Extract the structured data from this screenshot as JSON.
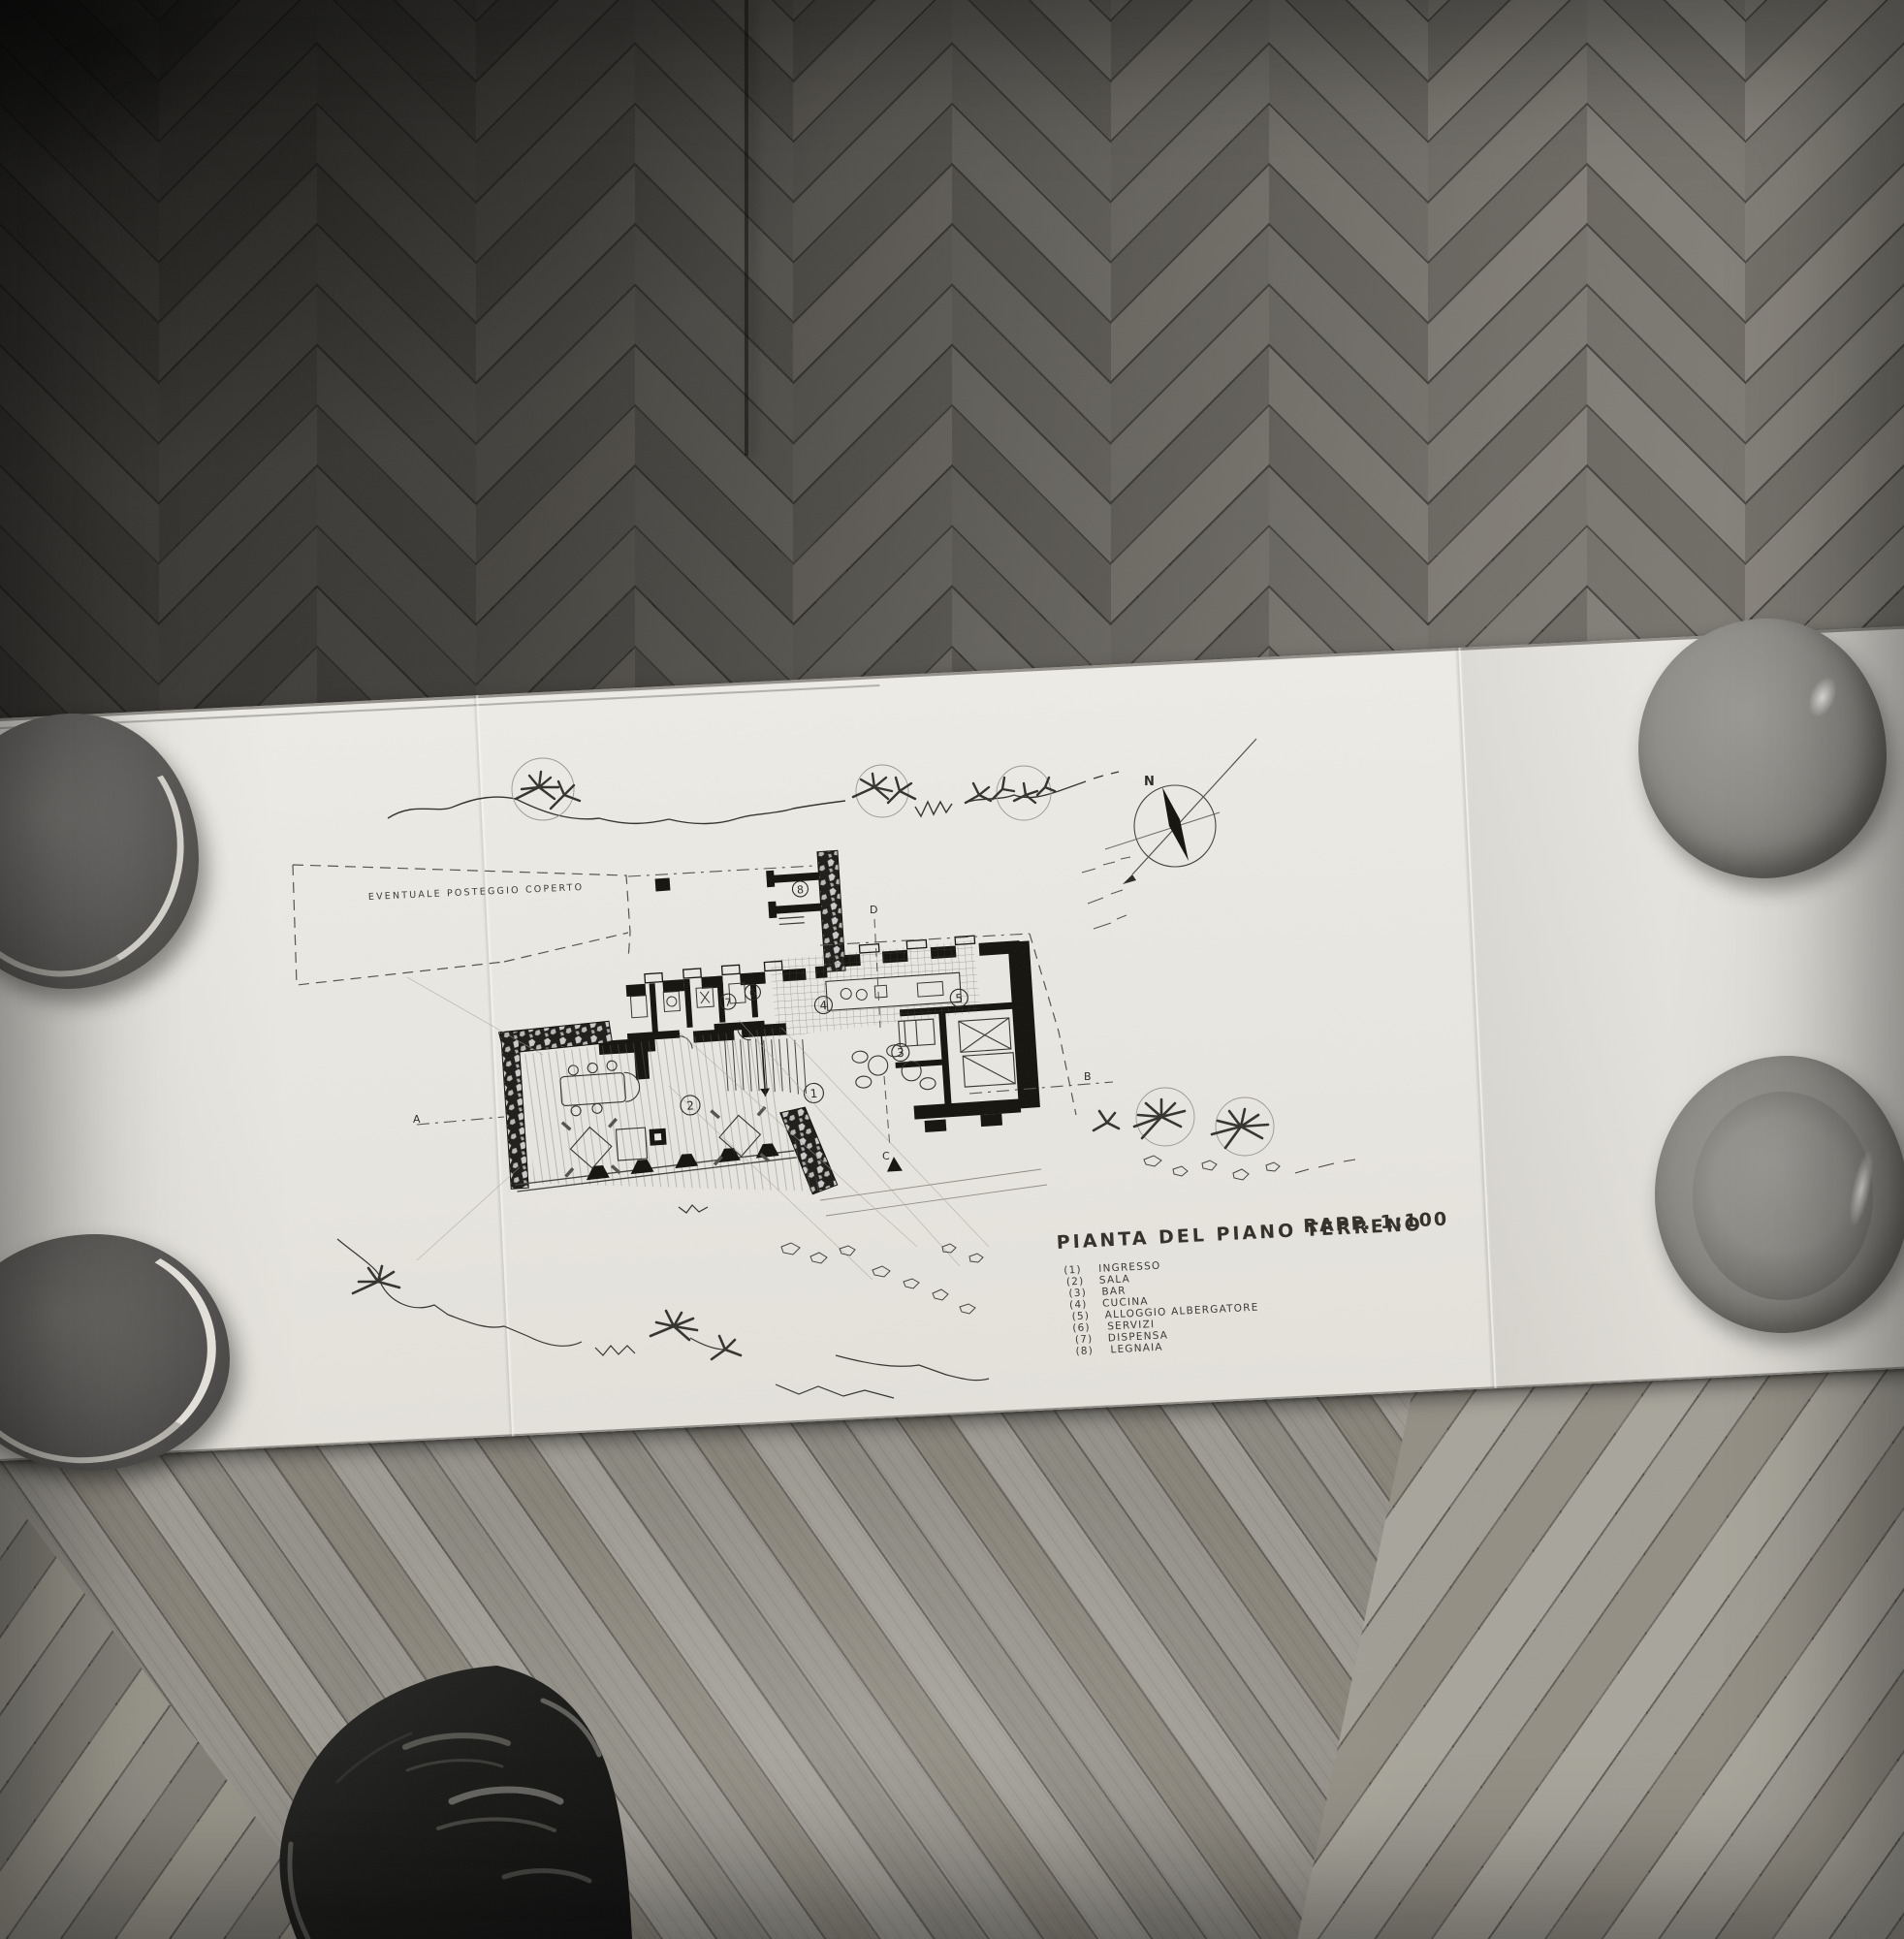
{
  "drawing": {
    "title": "PIANTA DEL PIANO TERRENO",
    "scale_label": "RAPP. 1:100",
    "annotation_parking": "EVENTUALE POSTEGGIO COPERTO",
    "compass_north_label": "N",
    "section_markers": {
      "a": "A",
      "b": "B",
      "c": "C",
      "d": "D"
    },
    "legend": {
      "items": [
        {
          "num": "(1)",
          "label": "INGRESSO"
        },
        {
          "num": "(2)",
          "label": "SALA"
        },
        {
          "num": "(3)",
          "label": "BAR"
        },
        {
          "num": "(4)",
          "label": "CUCINA"
        },
        {
          "num": "(5)",
          "label": "ALLOGGIO ALBERGATORE"
        },
        {
          "num": "(6)",
          "label": "SERVIZI"
        },
        {
          "num": "(7)",
          "label": "DISPENSA"
        },
        {
          "num": "(8)",
          "label": "LEGNAIA"
        }
      ]
    },
    "plan_room_numbers": [
      "1",
      "2",
      "3",
      "4",
      "5",
      "6",
      "7",
      "8"
    ]
  },
  "colors": {
    "paper": "#e8e6e0",
    "ink": "#2b2925",
    "pencil": "#8f8c84",
    "floor_dark": "#3e3c39",
    "floor_light": "#94918a",
    "bowl_dark": "#555350",
    "bowl_light": "#8e8c87",
    "shoe": "#191917"
  }
}
